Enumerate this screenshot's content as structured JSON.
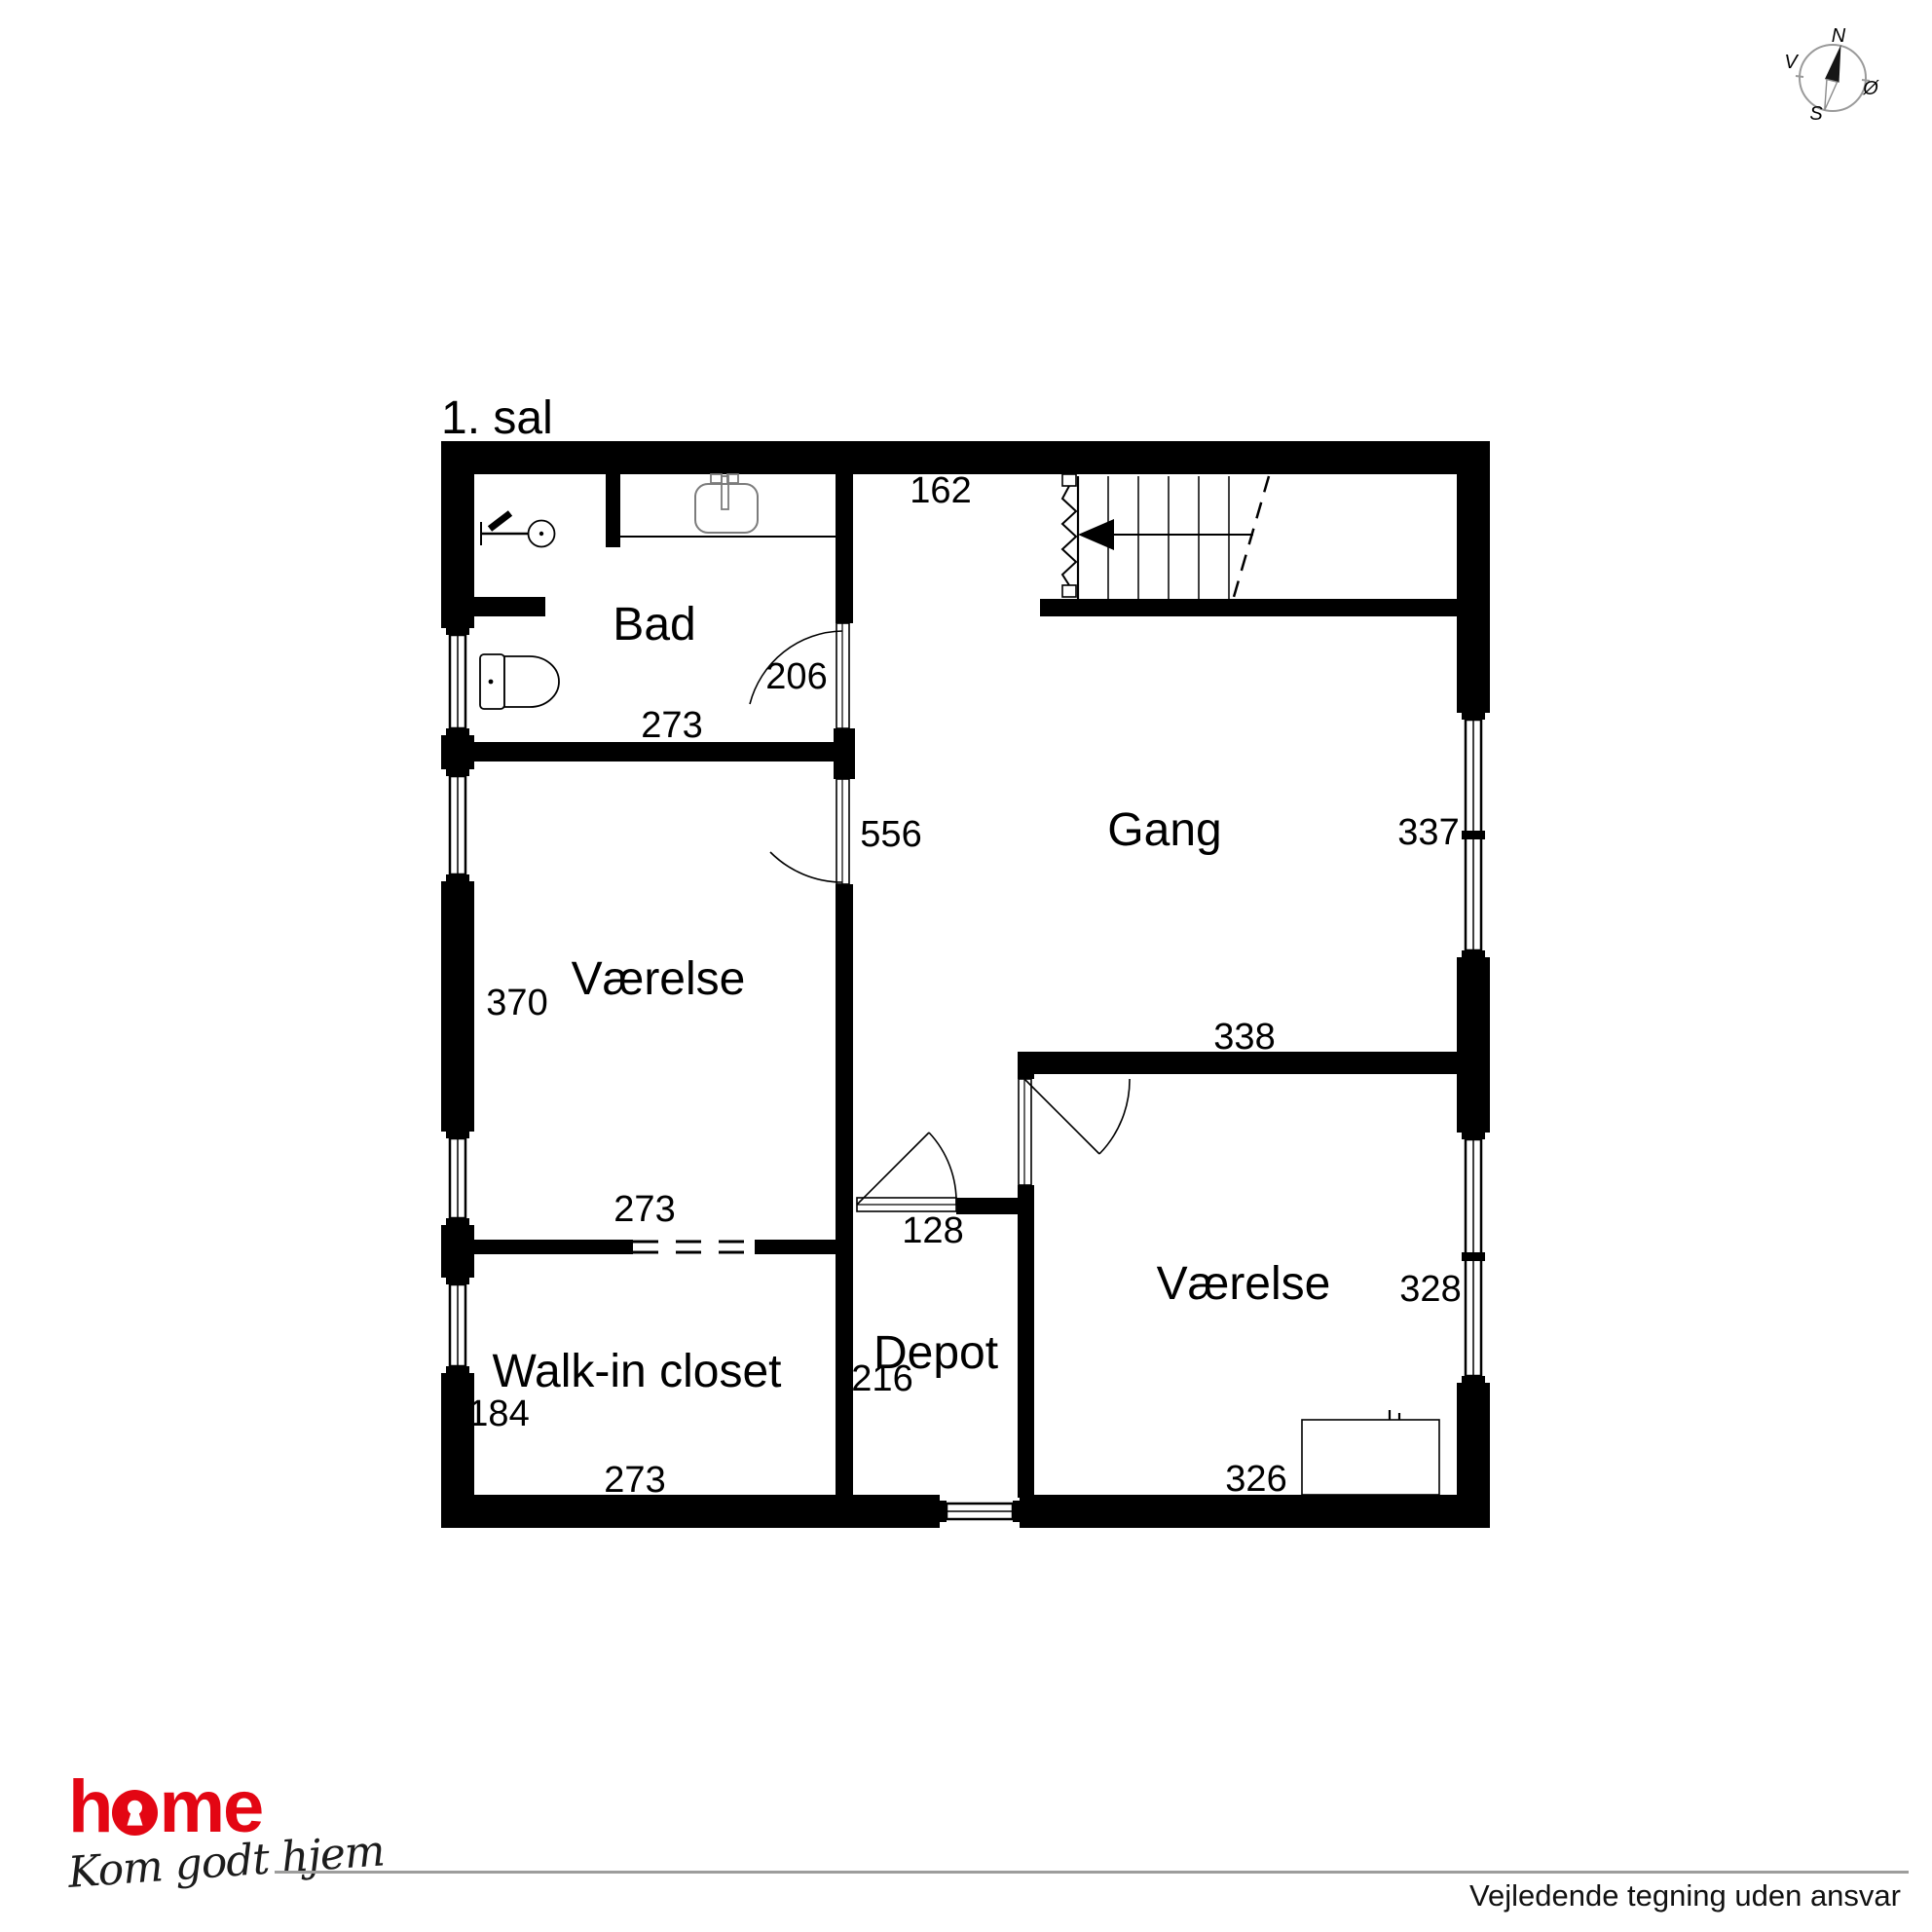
{
  "title": "1. sal",
  "compass": {
    "north": "N",
    "south": "S",
    "west": "V",
    "east": "Ø"
  },
  "rooms": {
    "bad": "Bad",
    "gang": "Gang",
    "vaerelse_left": "Værelse",
    "walk_in_closet": "Walk-in closet",
    "depot": "Depot",
    "vaerelse_right": "Værelse"
  },
  "dimensions": {
    "gang_top": "162",
    "bad_door": "206",
    "bad_width": "273",
    "vaerelse_left_door": "556",
    "gang_width": "337",
    "vaerelse_left_height": "370",
    "vaerelse_right_top": "338",
    "depot_door": "128",
    "closet_top": "273",
    "vaerelse_right_width": "328",
    "closet_height": "184",
    "depot_height": "216",
    "closet_width": "273",
    "vaerelse_right_bottom": "326"
  },
  "logo": {
    "brand_prefix": "h",
    "brand_suffix": "me",
    "tagline": "Kom godt hjem"
  },
  "footer": {
    "disclaimer": "Vejledende tegning uden ansvar"
  },
  "colors": {
    "wall": "#000000",
    "brand_red": "#e30613",
    "line_gray": "#9d9d9c"
  }
}
